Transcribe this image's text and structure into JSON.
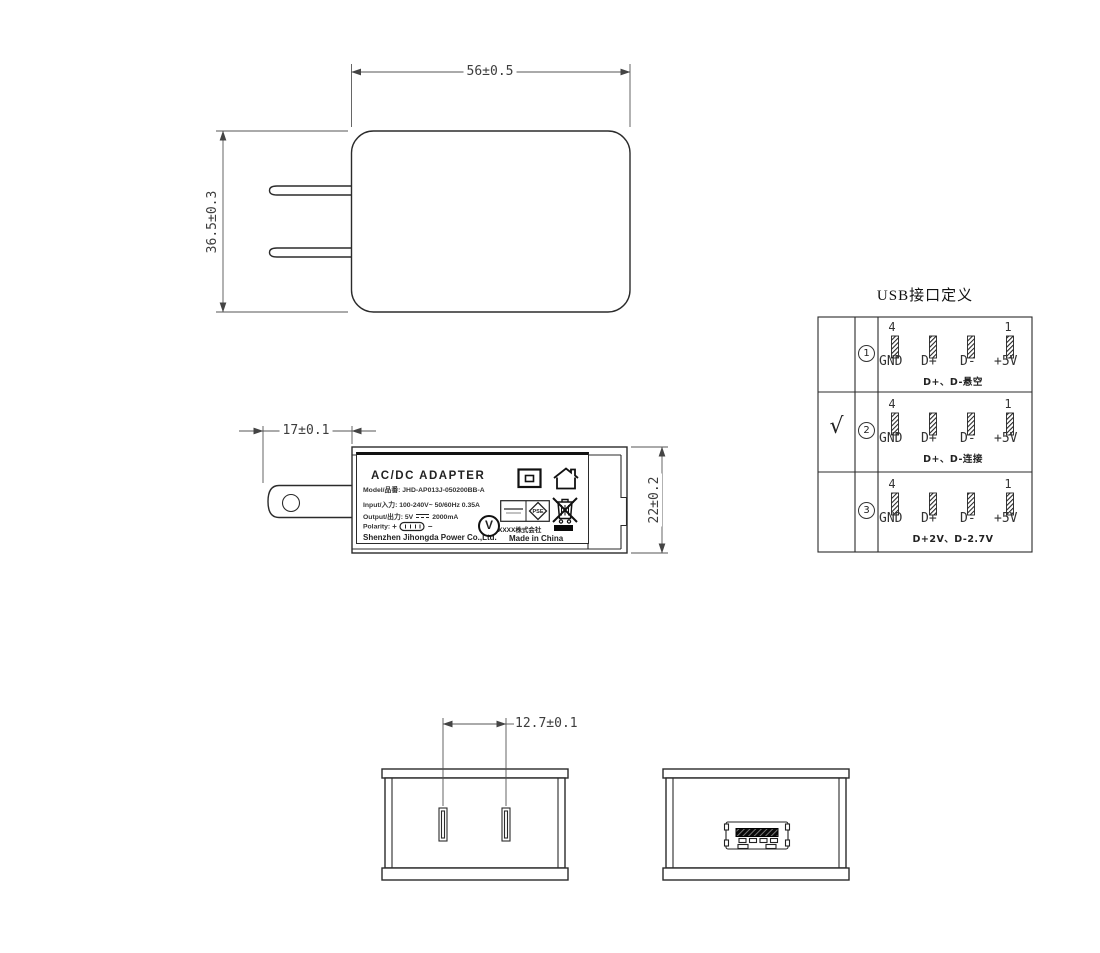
{
  "dimensions": {
    "body_width": "56±0.5",
    "body_height": "36.5±0.3",
    "pin_length": "17±0.1",
    "body_depth": "22±0.2",
    "prong_pitch": "12.7±0.1"
  },
  "label": {
    "title": "AC/DC  ADAPTER",
    "model_line": "Model/品番: JHD-AP013J-050200BB-A",
    "input_line": "Input/入力: 100-240V~  50/60Hz  0.35A",
    "output_prefix": "Output/出力: 5V",
    "output_suffix": "2000mA",
    "polarity_label": "Polarity:",
    "polarity_plus": "+",
    "polarity_minus": "−",
    "company": "Shenzhen Jihongda Power Co.,Ltd.",
    "maker_text": "XXXX株式会社",
    "made_in": "Made in China",
    "v_mark": "V",
    "pse_text": "PSE"
  },
  "usb_table": {
    "title": "USB接口定义",
    "rows": [
      {
        "check": "",
        "num": "1",
        "pin_first": "4",
        "pin_last": "1",
        "pins": [
          "GND",
          "D+",
          "D-",
          "+5V"
        ],
        "note": "D+、D-悬空"
      },
      {
        "check": "√",
        "num": "2",
        "pin_first": "4",
        "pin_last": "1",
        "pins": [
          "GND",
          "D+",
          "D-",
          "+5V"
        ],
        "note": "D+、D-连接"
      },
      {
        "check": "",
        "num": "3",
        "pin_first": "4",
        "pin_last": "1",
        "pins": [
          "GND",
          "D+",
          "D-",
          "+5V"
        ],
        "note": "D+2V、D-2.7V"
      }
    ]
  }
}
